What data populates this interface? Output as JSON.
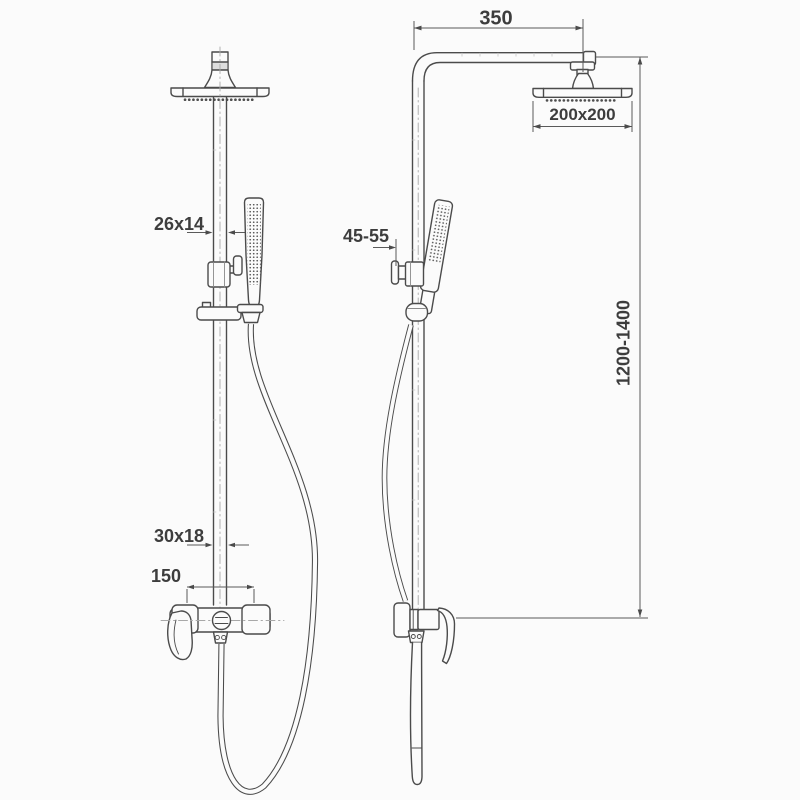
{
  "drawing": {
    "background_color": "#fbfbfb",
    "line_color": "#4b4b4b",
    "text_color": "#3d3d3d",
    "labels": {
      "arm_reach": "350",
      "head_size": "200x200",
      "upper_pipe_profile": "26x14",
      "holder_adjust_range": "45-55",
      "column_height_range": "1200-1400",
      "lower_pipe_profile": "30x18",
      "inlet_spacing": "150"
    }
  }
}
